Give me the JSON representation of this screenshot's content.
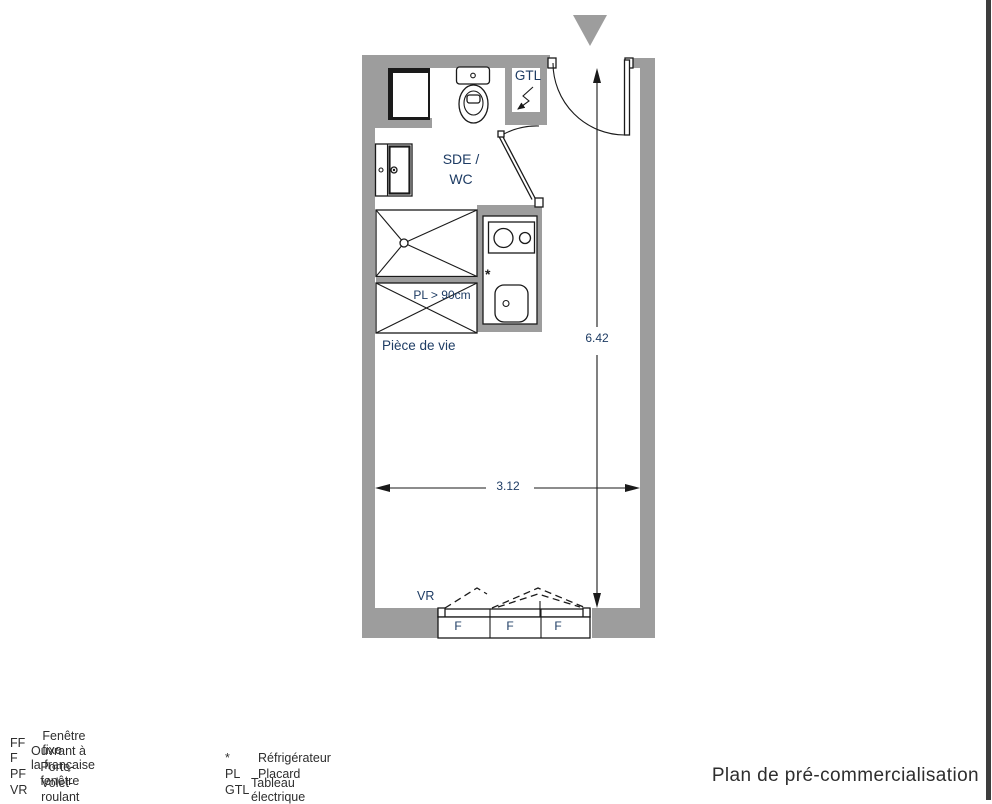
{
  "title": "Plan de pré-commercialisation",
  "plan": {
    "labels": {
      "gtl": "GTL",
      "bathroom_line1": "SDE /",
      "bathroom_line2": "WC",
      "closet": "PL > 90cm",
      "living_room": "Pièce de vie",
      "shutter": "VR",
      "fridge_marker": "*"
    },
    "dimensions": {
      "height": "6.42",
      "width": "3.12"
    },
    "windows": [
      "F",
      "F",
      "F"
    ],
    "colors": {
      "wall": "#9d9d9d",
      "line": "#1a1a1a",
      "label": "#1e3c64",
      "text": "#2e2e2e"
    }
  },
  "legend": {
    "column1": [
      {
        "abbr": "FF",
        "label": "Fenêtre fixe"
      },
      {
        "abbr": "F",
        "label": "Ouvrant à la française"
      },
      {
        "abbr": "PF",
        "label": "Porte-fenêtre"
      },
      {
        "abbr": "VR",
        "label": "Volet-roulant"
      }
    ],
    "column2": [
      {
        "abbr": "*",
        "label": "Réfrigérateur"
      },
      {
        "abbr": "PL",
        "label": "Placard"
      },
      {
        "abbr": "GTL",
        "label": "Tableau électrique"
      }
    ]
  }
}
